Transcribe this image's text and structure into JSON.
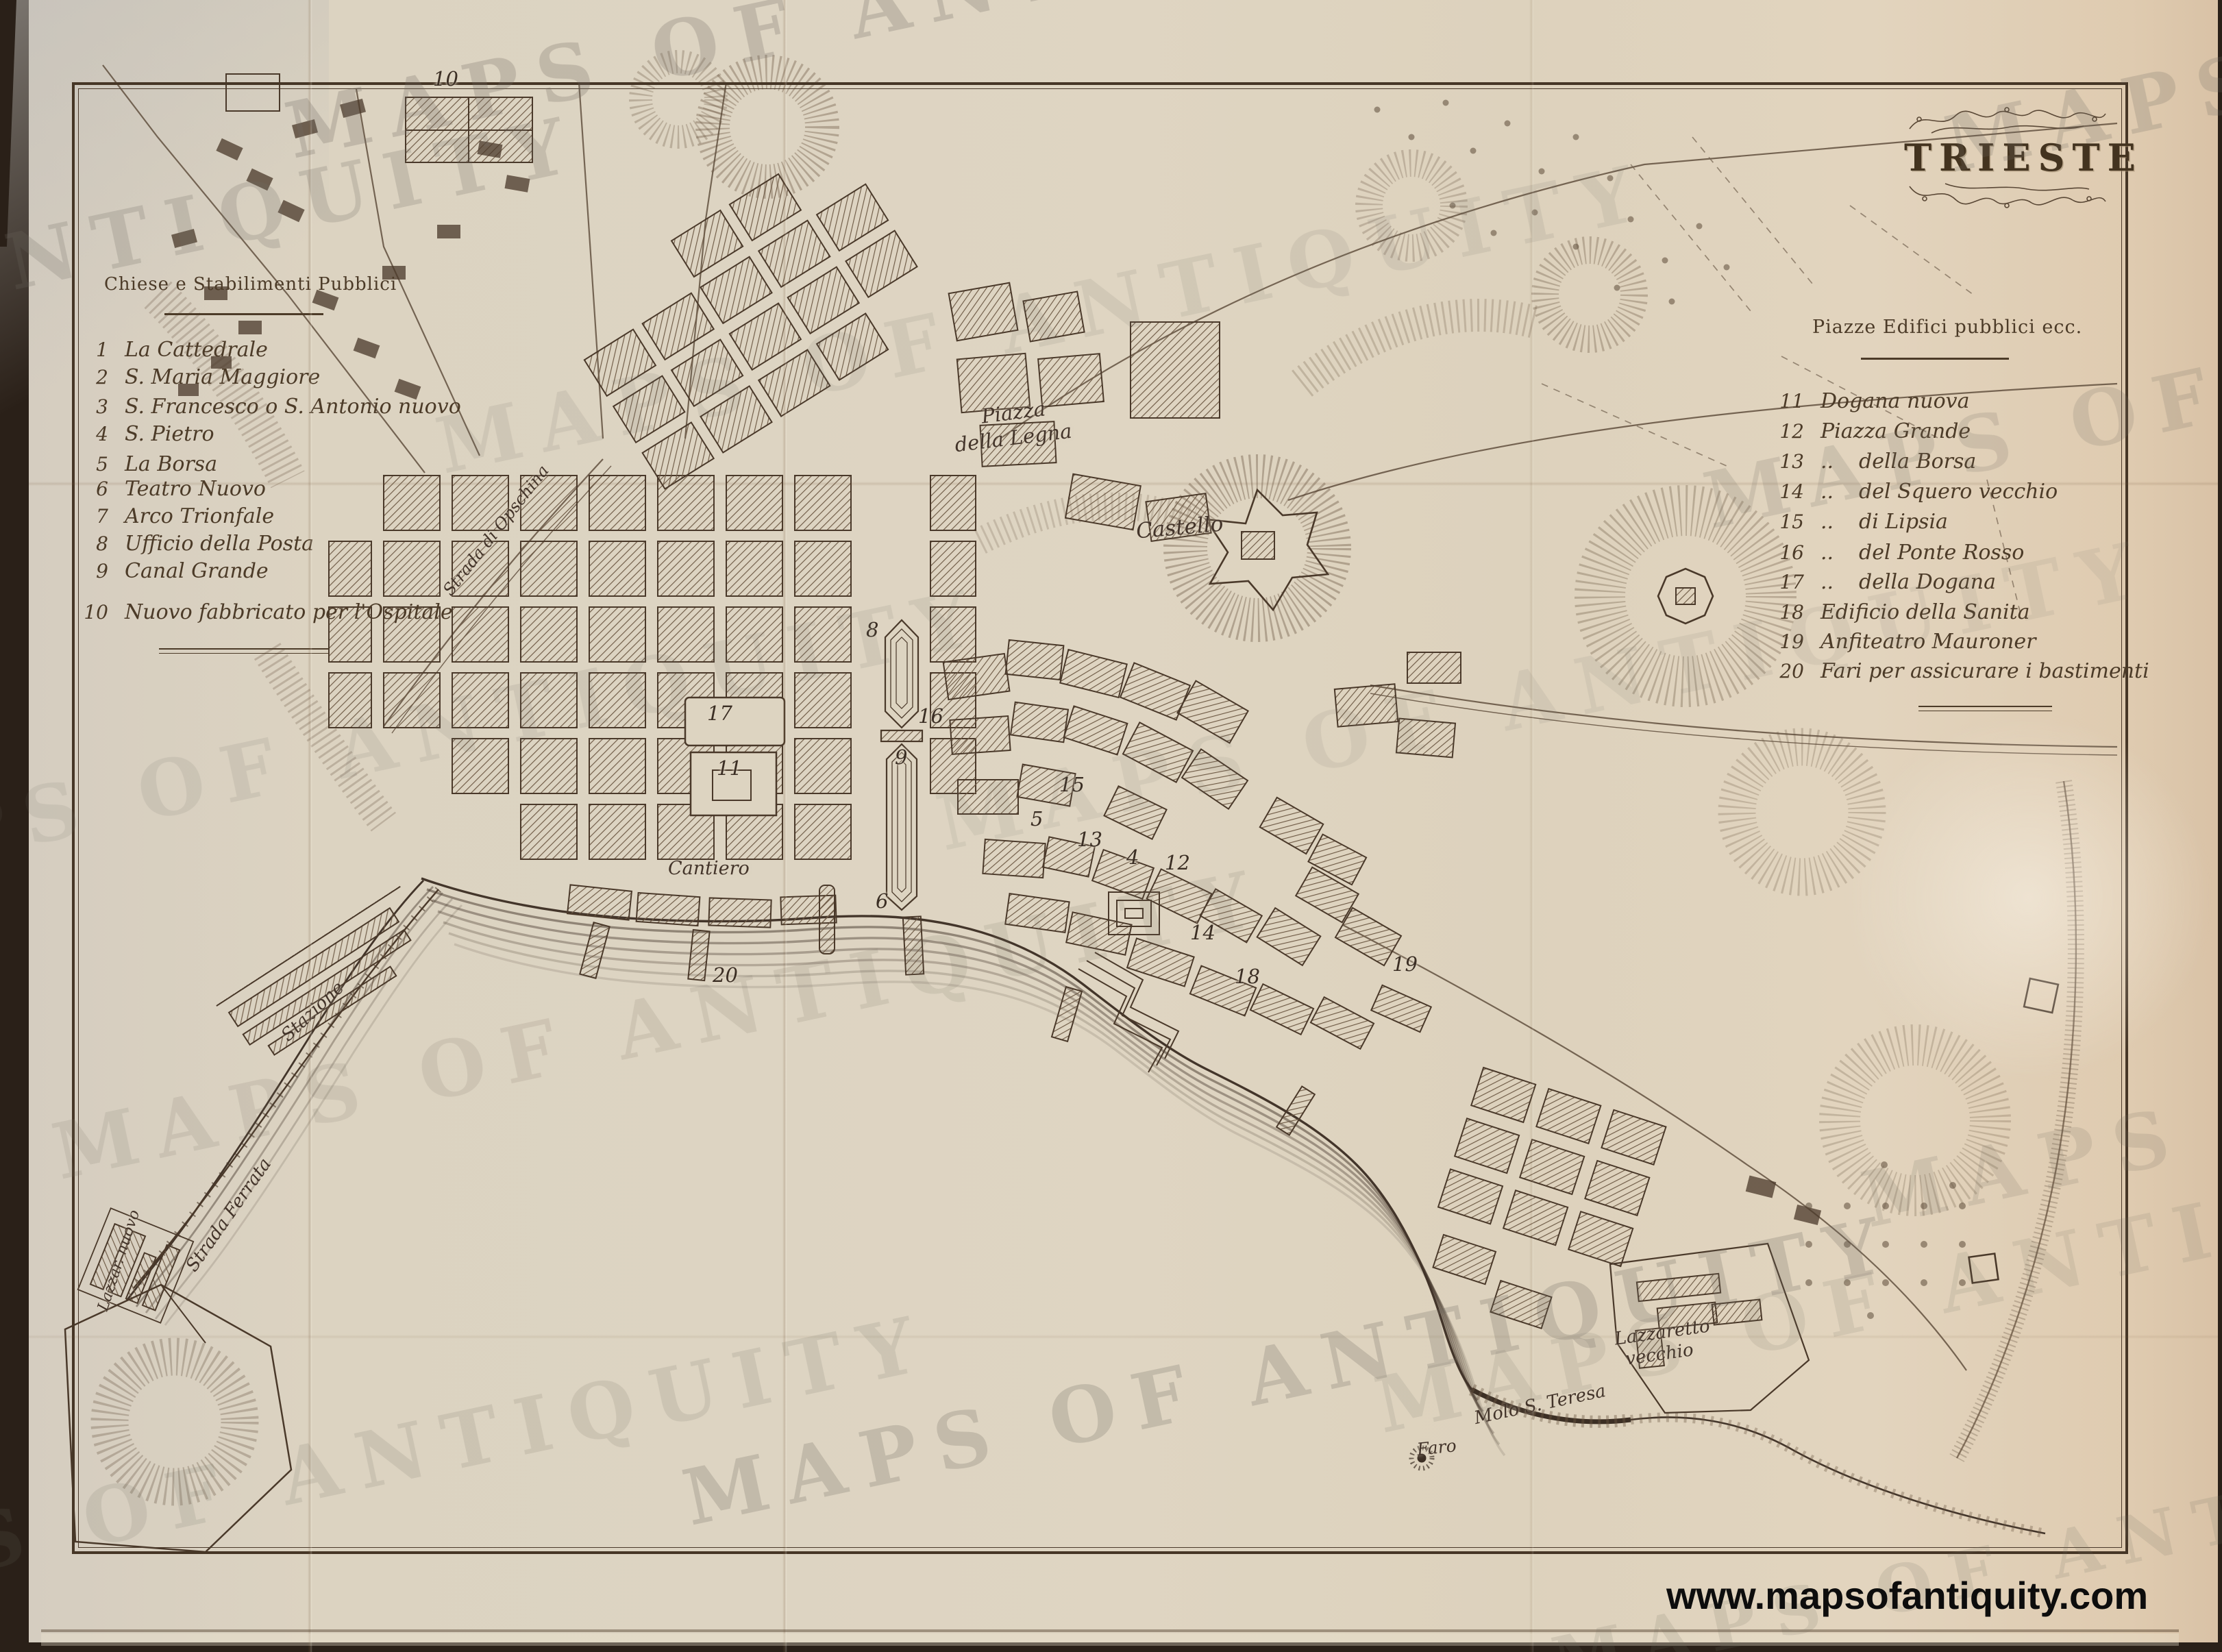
{
  "photo": {
    "watermark": "MAPS OF ANTIQUITY",
    "url_text": "www.mapsofantiquity.com",
    "colors": {
      "paper": "#ddd4c1",
      "ink": "#4a392a",
      "photo_background": "#2a2018",
      "url_color": "#0d0d0d"
    }
  },
  "map": {
    "title": "TRIESTE",
    "legend_left": {
      "heading": "Chiese e Stabilimenti Pubblici",
      "items": [
        {
          "num": "1",
          "label": "La Cattedrale"
        },
        {
          "num": "2",
          "label": "S. Maria Maggiore"
        },
        {
          "num": "3",
          "label": "S. Francesco o S. Antonio nuovo"
        },
        {
          "num": "4",
          "label": "S. Pietro"
        },
        {
          "num": "5",
          "label": "La Borsa"
        },
        {
          "num": "6",
          "label": "Teatro Nuovo"
        },
        {
          "num": "7",
          "label": "Arco Trionfale"
        },
        {
          "num": "8",
          "label": "Ufficio della Posta"
        },
        {
          "num": "9",
          "label": "Canal Grande"
        },
        {
          "num": "10",
          "label": "Nuovo fabbricato per l'Ospitale"
        }
      ]
    },
    "legend_right": {
      "heading": "Piazze Edifici pubblici ecc.",
      "items": [
        {
          "num": "11",
          "label": "Dogana nuova"
        },
        {
          "num": "12",
          "label": "Piazza Grande"
        },
        {
          "num": "13",
          "ditto": "..",
          "label": "della Borsa"
        },
        {
          "num": "14",
          "ditto": "..",
          "label": "del Squero vecchio"
        },
        {
          "num": "15",
          "ditto": "..",
          "label": "di Lipsia"
        },
        {
          "num": "16",
          "ditto": "..",
          "label": "del Ponte Rosso"
        },
        {
          "num": "17",
          "ditto": "..",
          "label": "della Dogana"
        },
        {
          "num": "18",
          "label": "Edificio della Sanita"
        },
        {
          "num": "19",
          "label": "Anfiteatro Mauroner"
        },
        {
          "num": "20",
          "label": "Fari per assicurare i bastimenti"
        }
      ]
    },
    "labels": [
      {
        "id": "piazza-line1",
        "text": "Piazza"
      },
      {
        "id": "piazza-line2",
        "text": "della Legna"
      },
      {
        "id": "castello",
        "text": "Castello"
      },
      {
        "id": "cantiero",
        "text": "Cantiero"
      },
      {
        "id": "stazione",
        "text": "Stazione"
      },
      {
        "id": "strada-ferrata",
        "text": "Strada Ferrata"
      },
      {
        "id": "lazzaretto-nuovo",
        "text": "Lazzar. nuovo"
      },
      {
        "id": "lazzaretto-vecchio-1",
        "text": "Lazzaretto"
      },
      {
        "id": "lazzaretto-vecchio-2",
        "text": "vecchio"
      },
      {
        "id": "molo-s-teresa",
        "text": "Molo S. Teresa"
      },
      {
        "id": "faro",
        "text": "Faro"
      },
      {
        "id": "strada-opschina",
        "text": "Strada di Opschina"
      }
    ],
    "numbers": [
      "10",
      "17",
      "11",
      "16",
      "8",
      "5",
      "9",
      "15",
      "13",
      "4",
      "12",
      "14",
      "18",
      "19",
      "20",
      "6"
    ]
  }
}
